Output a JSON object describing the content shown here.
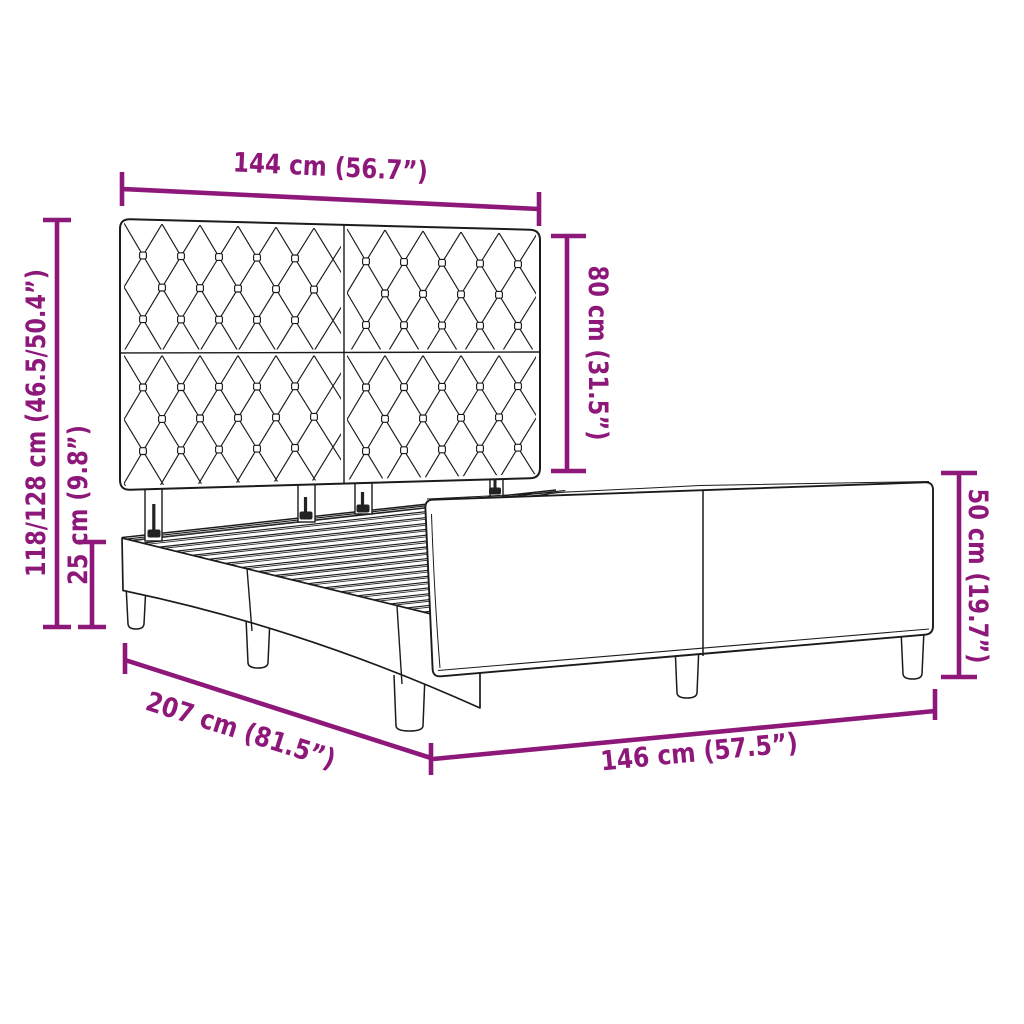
{
  "diagram": {
    "subject": "bed frame with upholstered diamond-tufted headboard",
    "background_color": "#ffffff",
    "accent_color": "#8e1879",
    "outline_color": "#1b1b1b",
    "dimensions": {
      "headboard_width": "144 cm (56.7”)",
      "headboard_height": "80 cm (31.5”)",
      "total_height": "118/128 cm (46.5/50.4”)",
      "base_height": "25 cm (9.8”)",
      "footboard_height": "50 cm (19.7”)",
      "bed_length": "207 cm (81.5”)",
      "bed_width": "146 cm (57.5”)"
    }
  }
}
